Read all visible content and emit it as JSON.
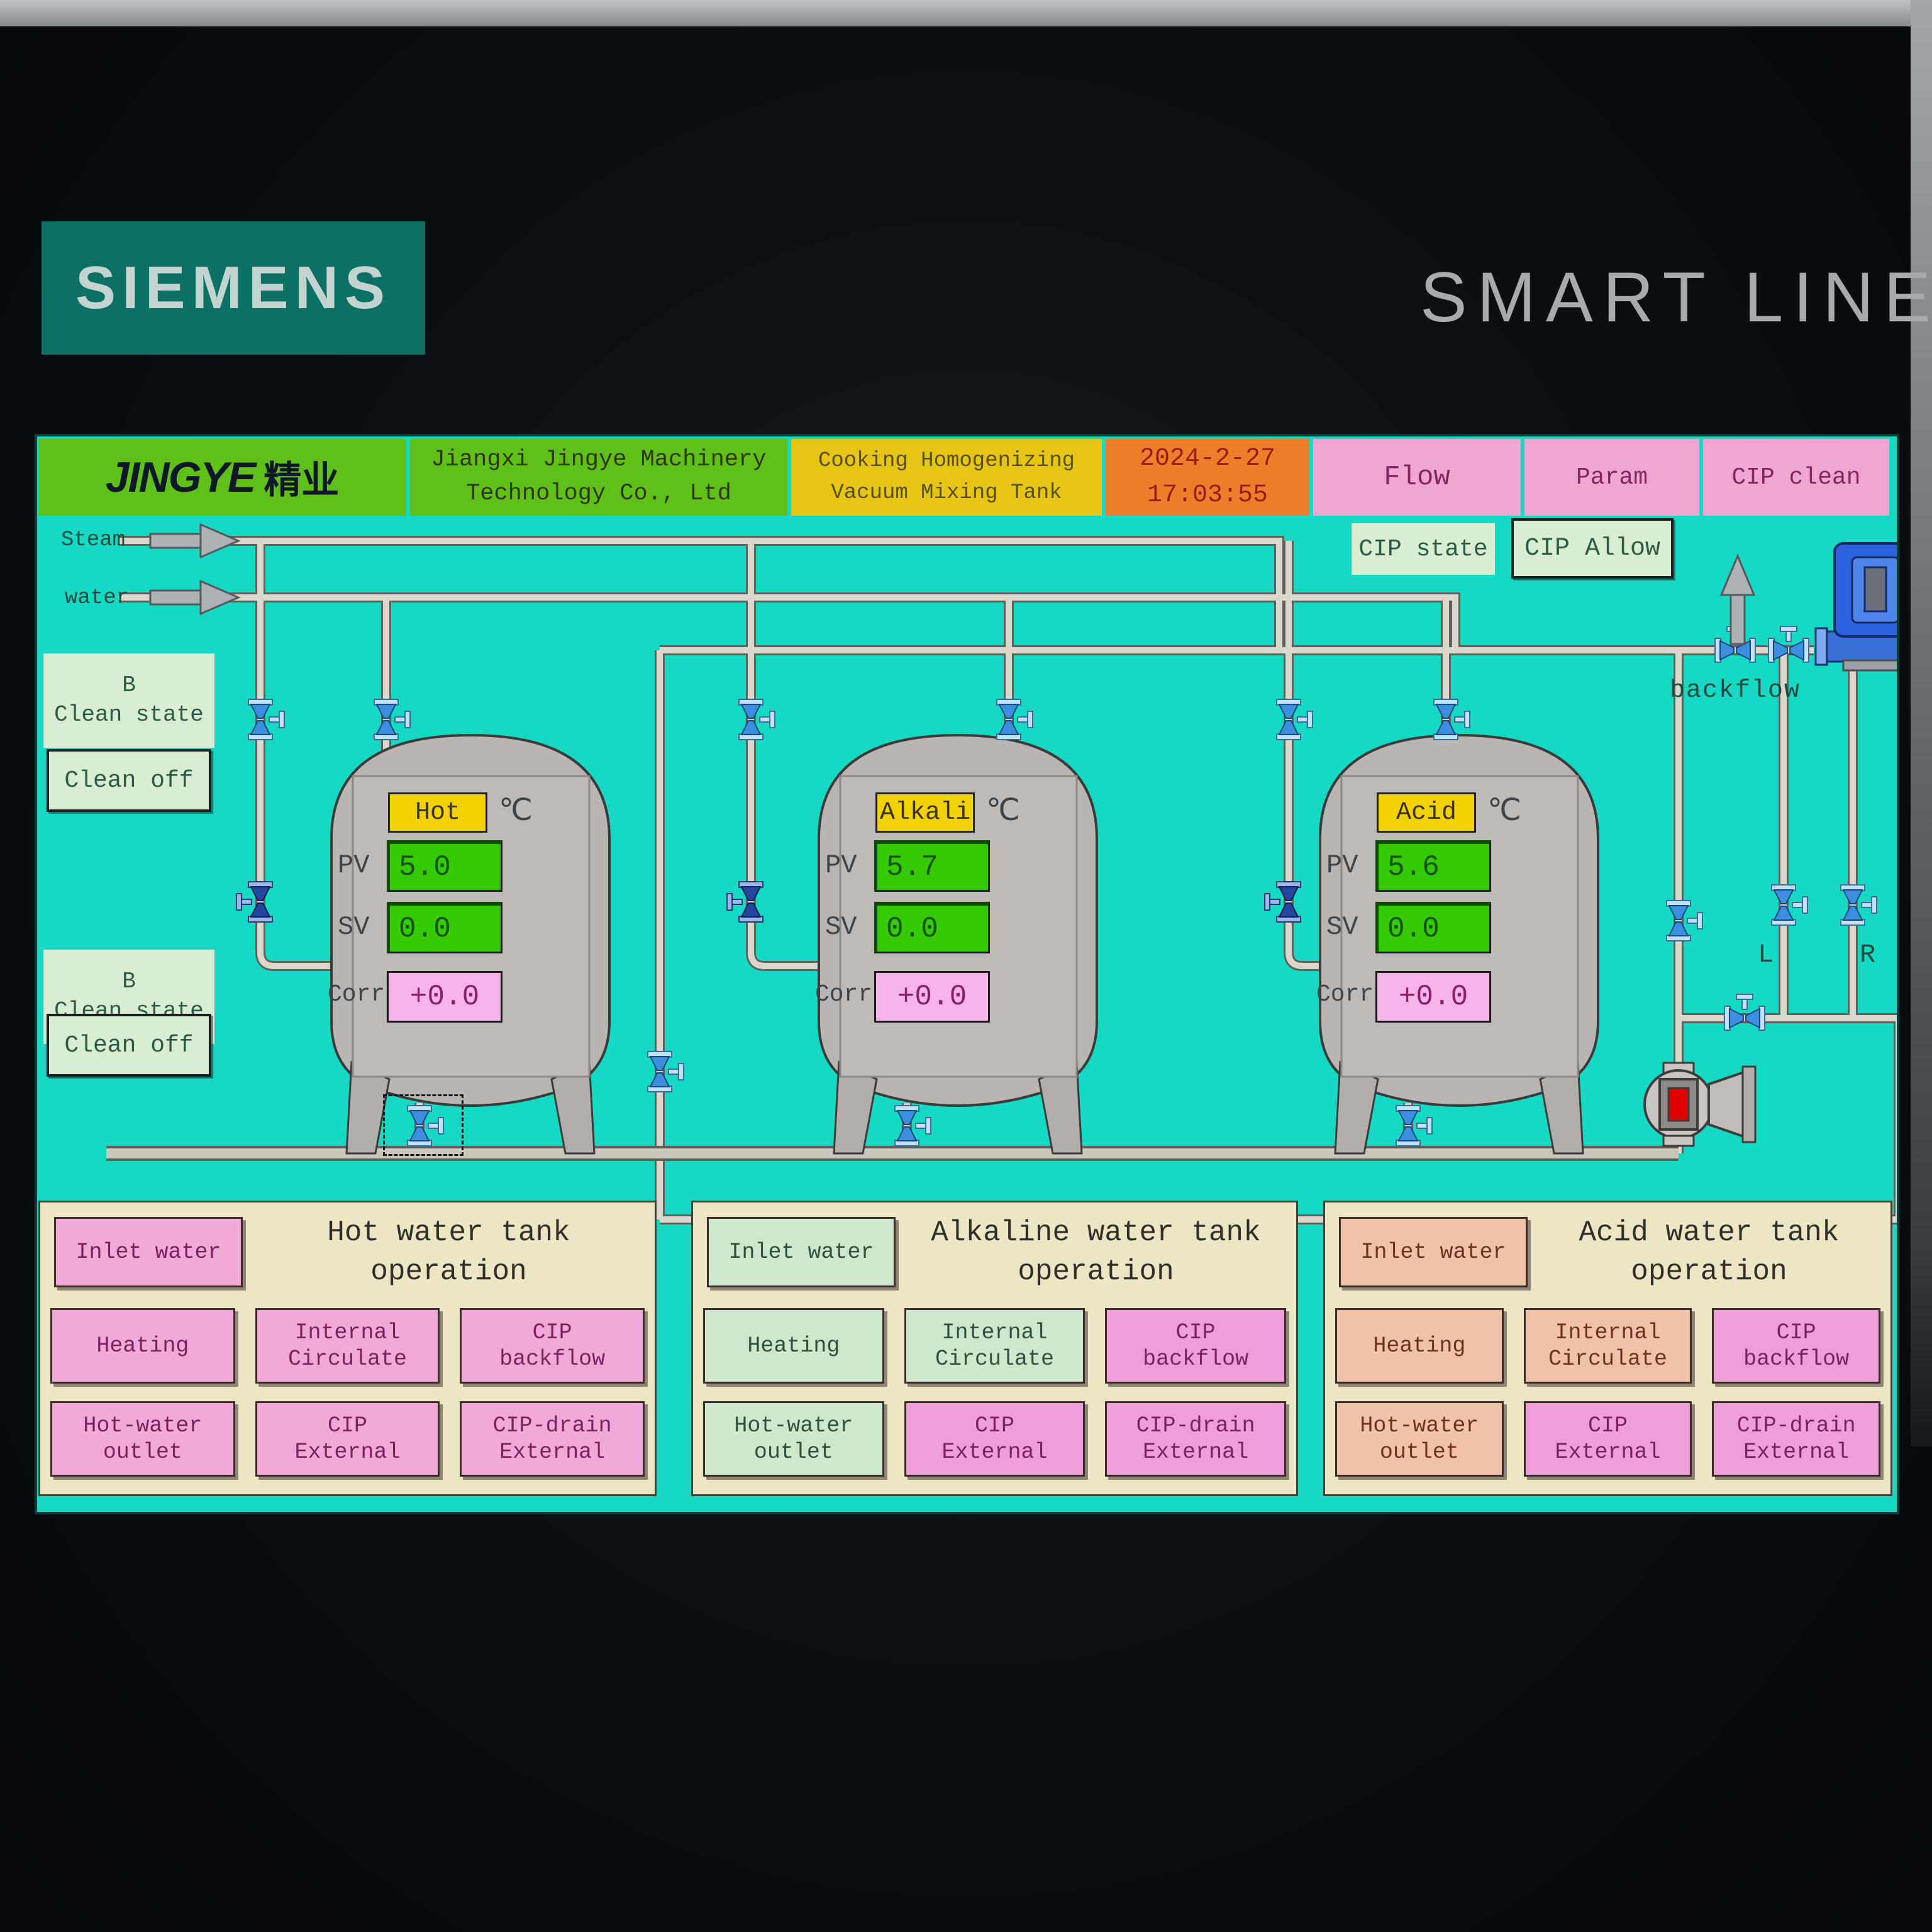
{
  "device": {
    "brand": "SIEMENS",
    "model": "SMART LINE"
  },
  "header": {
    "logo_text": "JINGYE",
    "logo_cn": "精业",
    "company_line1": "Jiangxi Jingye Machinery",
    "company_line2": "Technology Co., Ltd",
    "title_line1": "Cooking Homogenizing",
    "title_line2": "Vacuum Mixing Tank",
    "date": "2024-2-27",
    "time": "17:03:55",
    "nav": [
      {
        "label": "Flow"
      },
      {
        "label": "Param"
      },
      {
        "label": "CIP clean"
      }
    ]
  },
  "cip": {
    "state_label": "CIP state",
    "allow_label": "CIP Allow"
  },
  "supply": {
    "steam_label": "Steam",
    "water_label": "water"
  },
  "clean_controls": [
    {
      "state_line1": "B",
      "state_line2": "Clean state",
      "button_label": "Clean off"
    },
    {
      "state_line1": "B",
      "state_line2": "Clean state",
      "button_label": "Clean off"
    }
  ],
  "tanks": [
    {
      "name": "Hot",
      "unit": "℃",
      "pv_label": "PV",
      "pv": "5.0",
      "sv_label": "SV",
      "sv": "0.0",
      "corr_label": "Corr",
      "corr": "+0.0"
    },
    {
      "name": "Alkali",
      "unit": "℃",
      "pv_label": "PV",
      "pv": "5.7",
      "sv_label": "SV",
      "sv": "0.0",
      "corr_label": "Corr",
      "corr": "+0.0"
    },
    {
      "name": "Acid",
      "unit": "℃",
      "pv_label": "PV",
      "pv": "5.6",
      "sv_label": "SV",
      "sv": "0.0",
      "corr_label": "Corr",
      "corr": "+0.0"
    }
  ],
  "diagram_labels": {
    "backflow": "backflow",
    "left_pipe": "L",
    "right_pipe": "R"
  },
  "colors": {
    "screen": "#16d9c3",
    "header_green": "#5fc117",
    "header_yellow": "#e7c514",
    "header_orange": "#ee7f2a",
    "nav_pink": "#f0a6d2",
    "pale_green": "#d9edd3",
    "pv_green": "#35cb02",
    "corr_pink": "#f8b4e9",
    "tank_label_yellow": "#f2d203"
  },
  "panels": [
    {
      "title_line1": "Hot water tank",
      "title_line2": "operation",
      "buttons": [
        {
          "line1": "Inlet water",
          "bg": "#f1a9d7",
          "fg": "#7c2160"
        },
        {
          "line1": "Heating",
          "bg": "#f1a9d7",
          "fg": "#7c2160"
        },
        {
          "line1": "Internal",
          "line2": "Circulate",
          "bg": "#f1a9d7",
          "fg": "#7c2160"
        },
        {
          "line1": "CIP",
          "line2": "backflow",
          "bg": "#f1a9d7",
          "fg": "#7c2160"
        },
        {
          "line1": "Hot-water",
          "line2": "outlet",
          "bg": "#f1a9d7",
          "fg": "#7c2160"
        },
        {
          "line1": "CIP",
          "line2": "External",
          "bg": "#f1a9d7",
          "fg": "#7c2160"
        },
        {
          "line1": "CIP-drain",
          "line2": "External",
          "bg": "#f1a9d7",
          "fg": "#7c2160"
        }
      ]
    },
    {
      "title_line1": "Alkaline water tank",
      "title_line2": "operation",
      "buttons": [
        {
          "line1": "Inlet water",
          "bg": "#cde8cd",
          "fg": "#2e5140"
        },
        {
          "line1": "Heating",
          "bg": "#cde8cd",
          "fg": "#2e5140"
        },
        {
          "line1": "Internal",
          "line2": "Circulate",
          "bg": "#cde8cd",
          "fg": "#2e5140"
        },
        {
          "line1": "CIP",
          "line2": "backflow",
          "bg": "#ee9fd9",
          "fg": "#7c2160"
        },
        {
          "line1": "Hot-water",
          "line2": "outlet",
          "bg": "#cde8cd",
          "fg": "#2e5140"
        },
        {
          "line1": "CIP",
          "line2": "External",
          "bg": "#ee9fd9",
          "fg": "#7c2160"
        },
        {
          "line1": "CIP-drain",
          "line2": "External",
          "bg": "#ee9fd9",
          "fg": "#7c2160"
        }
      ]
    },
    {
      "title_line1": "Acid water tank",
      "title_line2": "operation",
      "buttons": [
        {
          "line1": "Inlet water",
          "bg": "#f0c3a9",
          "fg": "#6e3224"
        },
        {
          "line1": "Heating",
          "bg": "#f0c3a9",
          "fg": "#6e3224"
        },
        {
          "line1": "Internal",
          "line2": "Circulate",
          "bg": "#f0c3a9",
          "fg": "#6e3224"
        },
        {
          "line1": "CIP",
          "line2": "backflow",
          "bg": "#ee9fd9",
          "fg": "#7c2160"
        },
        {
          "line1": "Hot-water",
          "line2": "outlet",
          "bg": "#f0c3a9",
          "fg": "#6e3224"
        },
        {
          "line1": "CIP",
          "line2": "External",
          "bg": "#ee9fd9",
          "fg": "#7c2160"
        },
        {
          "line1": "CIP-drain",
          "line2": "External",
          "bg": "#ee9fd9",
          "fg": "#7c2160"
        }
      ]
    }
  ]
}
